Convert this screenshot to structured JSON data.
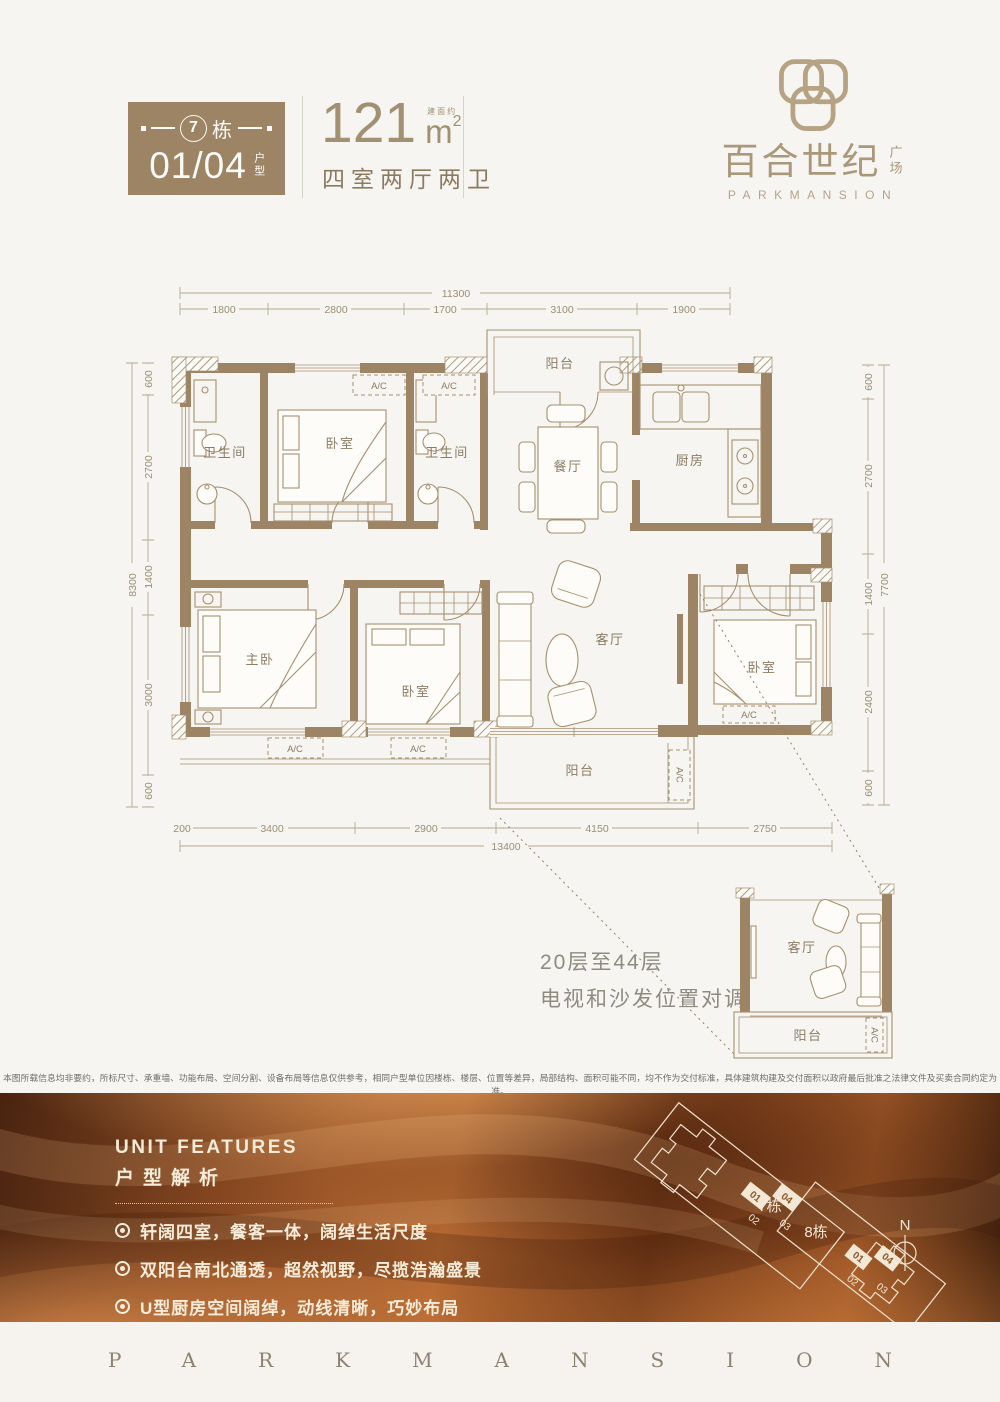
{
  "header": {
    "badge": {
      "building_number": "7",
      "building_suffix": "栋",
      "unit_numbers": "01/04",
      "unit_label": "户型"
    },
    "area": {
      "value": "121",
      "approx_label": "建面约",
      "unit": "m",
      "unit_sup": "2",
      "layout_text": "四室两厅两卫"
    },
    "logo": {
      "title_cn": "百合世纪",
      "title_cn_small": "广场",
      "title_en": "PARKMANSION"
    }
  },
  "floorplan": {
    "ac_label": "A/C",
    "dims": {
      "top": {
        "total": "11300",
        "segments": [
          "1800",
          "2800",
          "1700",
          "3100",
          "1900"
        ]
      },
      "bottom": {
        "total": "13400",
        "segments": [
          "200",
          "3400",
          "2900",
          "4150",
          "2750"
        ]
      },
      "left": {
        "total": "8300",
        "segments": [
          "600",
          "2700",
          "1400",
          "3000",
          "600"
        ]
      },
      "right": {
        "total": "7700",
        "segments": [
          "600",
          "2700",
          "1400",
          "2400",
          "600"
        ]
      }
    },
    "rooms": {
      "bath1": "卫生间",
      "bedroom_top": "卧室",
      "bath2": "卫生间",
      "balcony_top": "阳台",
      "dining": "餐厅",
      "kitchen": "厨房",
      "master": "主卧",
      "bedroom_mid": "卧室",
      "living": "客厅",
      "bedroom_right": "卧室",
      "balcony_bottom": "阳台"
    },
    "inset": {
      "note_line1": "20层至44层",
      "note_line2": "电视和沙发位置对调",
      "living": "客厅",
      "balcony": "阳台"
    }
  },
  "disclaimer": "本图所载信息均非要约，所标尺寸、承重墙、功能布局、空间分割、设备布局等信息仅供参考，相同户型单位因楼栋、楼层、位置等差异，局部结构、面积可能不同，均不作为交付标准，具体建筑构建及交付面积以政府最后批准之法律文件及买卖合同约定为准。",
  "features": {
    "title_en": "UNIT FEATURES",
    "title_cn": "户型解析",
    "items": [
      "轩阔四室，餐客一体，阔绰生活尺度",
      "双阳台南北通透，超然视野，尽揽浩瀚盛景",
      "U型厨房空间阔绰，动线清晰，巧妙布局",
      "主卧套间，独立卫浴、衣帽间，私密奢享"
    ]
  },
  "siteplan": {
    "building7": "7栋",
    "building8": "8栋",
    "units7": [
      "01",
      "04",
      "02",
      "03"
    ],
    "units8": [
      "01",
      "04",
      "02",
      "03"
    ],
    "compass": "N"
  },
  "footer": {
    "brand": "PARKMANSION"
  }
}
